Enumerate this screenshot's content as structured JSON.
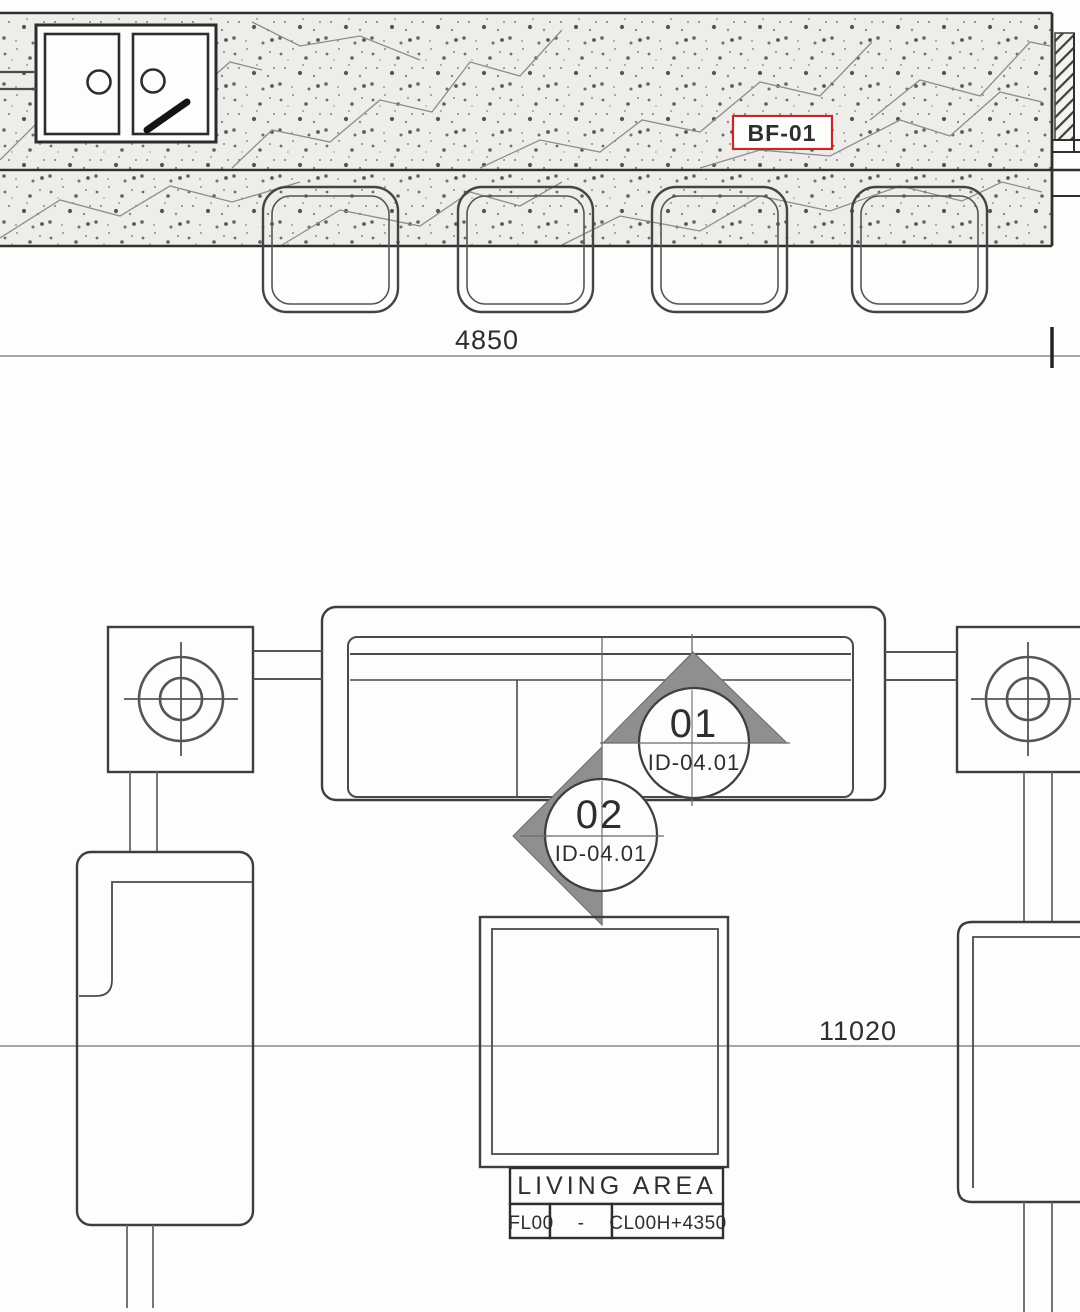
{
  "drawing": {
    "type": "interior floor plan detail",
    "room_label": {
      "name": "LIVING AREA",
      "floor": "FL00",
      "separator": "-",
      "ceiling": "CL00H+4350"
    },
    "finish_tag": "BF-01",
    "dimensions": {
      "counter_width": "4850",
      "room_width": "11020"
    },
    "markers": {
      "m01": {
        "number": "01",
        "sheet": "ID-04.01"
      },
      "m02": {
        "number": "02",
        "sheet": "ID-04.01"
      }
    }
  },
  "colors": {
    "line": "#3c3c3c",
    "accent_red": "#c62828",
    "marker_fill": "#8f8f8f",
    "texture_bg": "#efede9"
  }
}
